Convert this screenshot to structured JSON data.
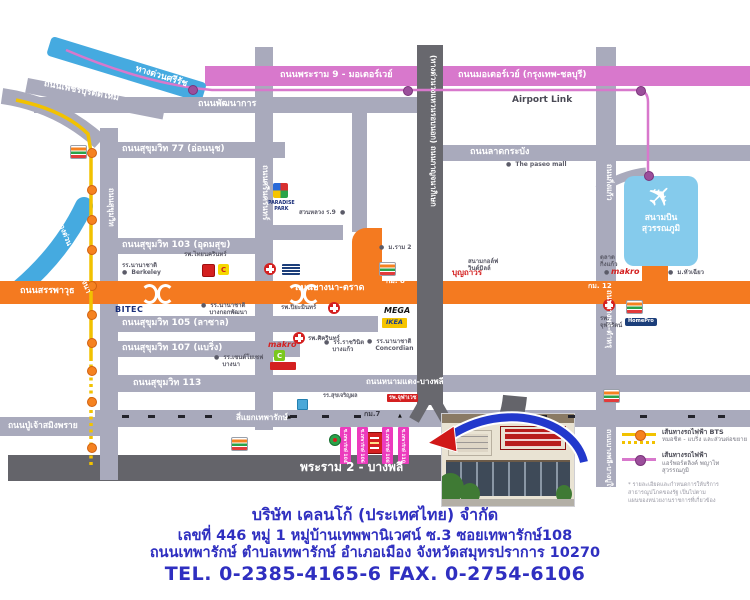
{
  "colors": {
    "white": "#ffffff",
    "road_gray": "#a9aabc",
    "road_dark": "#68686e",
    "road_dark2": "#64646a",
    "orange": "#f47a20",
    "pink_road": "#d878cc",
    "rail_dot_purple": "#9b4f9b",
    "expressway_blue": "#45aae0",
    "airport_blue": "#85cbec",
    "bts_yellow": "#f2c200",
    "bts_dot_orange": "#f58220",
    "soi_magenta": "#ec3bbd",
    "company_blue": "#2f2fc0",
    "accent_red": "#d42020",
    "label_gray": "#5b5b68"
  },
  "map": {
    "airport": {
      "plane_icon": "✈",
      "name": "สนามบิน\nสุวรรณภูมิ"
    },
    "labels": [
      {
        "n": "label-expressway-sirat",
        "t": "ทางด่วนศรีรัช",
        "x": 137,
        "y": 64,
        "c": "road",
        "r": 17
      },
      {
        "n": "label-rama9-motorway",
        "t": "ถนนพระราม 9 - มอเตอร์เวย์",
        "x": 280,
        "y": 70,
        "c": "road"
      },
      {
        "n": "label-motorway-bangkok-chonburi",
        "t": "ถนนมอเตอร์เวย์ (กรุงเทพ-ชลบุรี)",
        "x": 458,
        "y": 70,
        "c": "road"
      },
      {
        "n": "label-petchburi-tadmai",
        "t": "ถนนเพชรบุรีตัดใหม่",
        "x": 45,
        "y": 79,
        "c": "road",
        "r": 11
      },
      {
        "n": "label-pattanakarn",
        "t": "ถนนพัฒนาการ",
        "x": 198,
        "y": 99,
        "c": "road"
      },
      {
        "n": "label-airport-link",
        "t": "Airport Link",
        "x": 512,
        "y": 95,
        "c": "dark"
      },
      {
        "n": "label-ladkrabang",
        "t": "ถนนลาดกระบัง",
        "x": 470,
        "y": 147,
        "c": "road"
      },
      {
        "n": "label-sukhumvit-77",
        "t": "ถนนสุขุมวิท 77 (อ่อนนุช)",
        "x": 122,
        "y": 144,
        "c": "road"
      },
      {
        "n": "label-sukhumvit-103",
        "t": "ถนนสุขุมวิท 103 (อุดมสุข)",
        "x": 122,
        "y": 240,
        "c": "road"
      },
      {
        "n": "label-sanphawut",
        "t": "ถนนสรรพาวุธ",
        "x": 20,
        "y": 286,
        "c": "road"
      },
      {
        "n": "label-bangna-trad",
        "t": "ถนนบางนา-ตราด",
        "x": 295,
        "y": 283,
        "c": "road"
      },
      {
        "n": "label-km8",
        "t": "กม. 8",
        "x": 386,
        "y": 277,
        "c": "roadsm"
      },
      {
        "n": "label-km12",
        "t": "กม. 12",
        "x": 588,
        "y": 282,
        "c": "roadsm"
      },
      {
        "n": "label-sukhumvit-105",
        "t": "ถนนสุขุมวิท 105 (ลาซาล)",
        "x": 122,
        "y": 318,
        "c": "road"
      },
      {
        "n": "label-sukhumvit-107",
        "t": "ถนนสุขุมวิท 107 (แบริ่ง)",
        "x": 122,
        "y": 343,
        "c": "road"
      },
      {
        "n": "label-sukhumvit-113",
        "t": "ถนนสุขุมวิท 113",
        "x": 133,
        "y": 378,
        "c": "road"
      },
      {
        "n": "label-namdaeng-bangphli",
        "t": "ถนนหนามแดง-บางพลี",
        "x": 366,
        "y": 377,
        "c": "road",
        "s": 8
      },
      {
        "n": "label-yaek-theparak",
        "t": "สี่แยกเทพารักษ์",
        "x": 236,
        "y": 413,
        "c": "road",
        "s": 8
      },
      {
        "n": "label-poochao-samingprai",
        "t": "ถนนปู่เจ้าสมิงพราย",
        "x": 8,
        "y": 421,
        "c": "road",
        "s": 8.5
      },
      {
        "n": "label-rama2-bangphli",
        "t": "พระราม 2 - บางพลี",
        "x": 300,
        "y": 460,
        "c": "road",
        "s": 12
      },
      {
        "n": "label-km7",
        "t": "กม.7",
        "x": 364,
        "y": 410,
        "c": "km"
      },
      {
        "n": "label-srinakarin",
        "t": "ถนนศรีนครินทร์",
        "x": 270,
        "y": 165,
        "c": "road",
        "r": 90,
        "s": 8
      },
      {
        "n": "label-sukhumvit-old",
        "t": "ถนนสุขุมวิท",
        "x": 115,
        "y": 188,
        "c": "road",
        "r": 90,
        "s": 7.5
      },
      {
        "n": "label-kanchanaphisek",
        "t": "(ทางด่วนวงแหวนรอบนอก) ถนนกาญจนาภิเษก",
        "x": 437,
        "y": 55,
        "c": "road",
        "r": 90,
        "s": 7.5
      },
      {
        "n": "label-kingkaeo",
        "t": "ถนนกิ่งแก้ว",
        "x": 613,
        "y": 164,
        "c": "road",
        "r": 90,
        "s": 7.5
      },
      {
        "n": "label-bangphli-tamru",
        "t": "ถนนบางพลี-ตำหรุ",
        "x": 613,
        "y": 290,
        "c": "road",
        "r": 90,
        "s": 7.5
      },
      {
        "n": "label-bangphli-bangpoo",
        "t": "ถนนบางพลี-บางปูใหม่",
        "x": 613,
        "y": 429,
        "c": "road",
        "r": 90,
        "s": 7
      },
      {
        "n": "label-dindaeng-bangna",
        "t": "ทางด่วน ดินแดง-บางนา",
        "x": 63,
        "y": 219,
        "c": "road",
        "r": 68,
        "s": 7.5
      },
      {
        "n": "label-paradise-park",
        "t": "PARADISE\nPARK",
        "x": 268,
        "y": 201,
        "c": "paradise"
      },
      {
        "n": "label-suanluang-r9",
        "t": "สวนหลวง ร.9  ●",
        "x": 299,
        "y": 209,
        "c": "land"
      },
      {
        "n": "label-ram2-university",
        "t": "●  ม.ราม 2",
        "x": 379,
        "y": 244,
        "c": "land"
      },
      {
        "n": "label-boonthavorn",
        "t": "บุญถาวร",
        "x": 452,
        "y": 268,
        "c": "redtx"
      },
      {
        "n": "label-paseo-mall",
        "t": "●  The paseo mall",
        "x": 506,
        "y": 161,
        "c": "land"
      },
      {
        "n": "label-windmill",
        "t": "สนามกอล์ฟ\nวินด์มิลล์",
        "x": 468,
        "y": 258,
        "c": "land"
      },
      {
        "n": "label-talad-kingkaeo",
        "t": "ตลาด\nกิ่งแก้ว",
        "x": 600,
        "y": 254,
        "c": "land"
      },
      {
        "n": "label-makro-kingkaeo-bullet",
        "t": "●",
        "x": 604,
        "y": 269,
        "c": "land"
      },
      {
        "n": "label-makro-kingkaeo",
        "t": "makro",
        "x": 611,
        "y": 267,
        "c": "red"
      },
      {
        "n": "label-huachiew",
        "t": "●  ม.หัวเฉียว",
        "x": 668,
        "y": 269,
        "c": "land"
      },
      {
        "n": "label-thainakarin-hospital",
        "t": "รพ.ไทยนครินทร์",
        "x": 184,
        "y": 251,
        "c": "land"
      },
      {
        "n": "label-berkeley-school",
        "t": "รร.นานาชาติ\n●  Berkeley",
        "x": 122,
        "y": 262,
        "c": "land"
      },
      {
        "n": "label-bitec",
        "t": "BITEC",
        "x": 115,
        "y": 305,
        "c": "navy"
      },
      {
        "n": "label-bangkok-patana-school",
        "t": "●  รร.นานาชาติ\n    บางกอกพัฒนา",
        "x": 201,
        "y": 302,
        "c": "land"
      },
      {
        "n": "label-piyamin-hospital",
        "t": "รพ.ปิยะมินทร์",
        "x": 281,
        "y": 304,
        "c": "land"
      },
      {
        "n": "label-sikarin-hospital",
        "t": "รพ.ศิครินทร์",
        "x": 308,
        "y": 335,
        "c": "land"
      },
      {
        "n": "label-rajavinit-bangkaeo",
        "t": "●  รร.ราชวินิต\n    บางแก้ว",
        "x": 324,
        "y": 339,
        "c": "land"
      },
      {
        "n": "label-concordian-school",
        "t": "●  รร.นานาชาติ\n    Concordian",
        "x": 367,
        "y": 338,
        "c": "land"
      },
      {
        "n": "label-mega",
        "t": "MEGA",
        "x": 384,
        "y": 306,
        "c": "mega"
      },
      {
        "n": "label-ikea",
        "t": "IKEA",
        "x": 382,
        "y": 318,
        "c": "ikea"
      },
      {
        "n": "label-stjoseph-bangna",
        "t": "●  รร.เซนต์โยเซฟ\n    บางนา",
        "x": 214,
        "y": 354,
        "c": "land"
      },
      {
        "n": "label-makro-srinakarin",
        "t": "makro",
        "x": 268,
        "y": 340,
        "c": "red"
      },
      {
        "n": "label-central-c",
        "t": "C",
        "x": 221,
        "y": 266,
        "c": "cred"
      },
      {
        "n": "label-green-c",
        "t": "C",
        "x": 277,
        "y": 352,
        "c": "cwhite"
      },
      {
        "n": "label-sukjaroen-school",
        "t": "รร.สุขเจริญผล",
        "x": 323,
        "y": 393,
        "c": "land",
        "s": 5.5
      },
      {
        "n": "label-chulavej-hospital",
        "t": "รพ.จุฬาเวช",
        "x": 387,
        "y": 394,
        "c": "badge"
      },
      {
        "n": "label-chularat-hospital",
        "t": "รพ.\nจุฬารัตน์",
        "x": 600,
        "y": 315,
        "c": "land"
      },
      {
        "n": "label-homepro",
        "t": "HomePro",
        "x": 625,
        "y": 318,
        "c": "homepro"
      },
      {
        "n": "label-entrance-mark-1",
        "t": "▲",
        "x": 287,
        "y": 415,
        "c": "arrow"
      },
      {
        "n": "label-entrance-mark-2",
        "t": "▲",
        "x": 398,
        "y": 414,
        "c": "arrow"
      }
    ],
    "icons": [
      {
        "n": "seven-eleven-icon",
        "k": "seven",
        "x": 70,
        "y": 145
      },
      {
        "n": "seven-eleven-icon",
        "k": "seven",
        "x": 379,
        "y": 262
      },
      {
        "n": "seven-eleven-icon",
        "k": "seven",
        "x": 231,
        "y": 437
      },
      {
        "n": "seven-eleven-icon",
        "k": "seven",
        "x": 626,
        "y": 300
      },
      {
        "n": "seven-eleven-icon",
        "k": "seven",
        "x": 603,
        "y": 389
      },
      {
        "n": "hospital-cross-icon",
        "k": "cross",
        "x": 264,
        "y": 263
      },
      {
        "n": "hospital-cross-icon",
        "k": "cross",
        "x": 328,
        "y": 302
      },
      {
        "n": "hospital-cross-icon",
        "k": "cross",
        "x": 293,
        "y": 332
      },
      {
        "n": "hospital-cross-icon",
        "k": "cross",
        "x": 603,
        "y": 299
      },
      {
        "n": "store-logo-red-icon",
        "k": "redsq",
        "x": 202,
        "y": 264
      },
      {
        "n": "central-logo-icon",
        "k": "cbox",
        "x": 218,
        "y": 264
      },
      {
        "n": "central-city-logo-icon",
        "k": "navy",
        "x": 282,
        "y": 264
      },
      {
        "n": "store-logo-green-icon",
        "k": "gbox",
        "x": 274,
        "y": 350
      },
      {
        "n": "store-logo-redwide-icon",
        "k": "redwide",
        "x": 270,
        "y": 362
      },
      {
        "n": "bank-logo-blue-icon",
        "k": "bluecube",
        "x": 297,
        "y": 399
      },
      {
        "n": "logo-green-circle-icon",
        "k": "gcircle",
        "x": 329,
        "y": 434
      },
      {
        "n": "paradise-park-logo-icon",
        "k": "paradise",
        "x": 273,
        "y": 183
      },
      {
        "n": "company-location-marker",
        "k": "marker",
        "x": 366,
        "y": 432
      },
      {
        "n": "poi-dot-icon",
        "k": "dotg",
        "x": 339,
        "y": 402
      },
      {
        "n": "interchange-arc-icon",
        "k": "arcl",
        "x": 141,
        "y": 284
      },
      {
        "n": "interchange-arc-icon",
        "k": "arcr",
        "x": 157,
        "y": 284
      },
      {
        "n": "interchange-arc-icon",
        "k": "arcl",
        "x": 287,
        "y": 284
      },
      {
        "n": "interchange-arc-icon",
        "k": "arcr",
        "x": 303,
        "y": 284
      }
    ],
    "bts_dots": [
      [
        87,
        148
      ],
      [
        87,
        185
      ],
      [
        87,
        215
      ],
      [
        87,
        245
      ],
      [
        87,
        281
      ],
      [
        87,
        310
      ],
      [
        87,
        338
      ],
      [
        87,
        366
      ],
      [
        87,
        397
      ],
      [
        87,
        443
      ]
    ],
    "arl_dots": [
      [
        188,
        85
      ],
      [
        403,
        86
      ],
      [
        636,
        86
      ],
      [
        644,
        171
      ]
    ],
    "bus_dashes": [
      122,
      148,
      178,
      205,
      290,
      322,
      354,
      512,
      540,
      568,
      640,
      688,
      718
    ],
    "sois": [
      {
        "t": "ซ.เทพารักษ์ 104",
        "x": 340
      },
      {
        "t": "ซ.เทพารักษ์ 106",
        "x": 357
      },
      {
        "t": "ซ.เทพารักษ์ 108",
        "x": 382
      },
      {
        "t": "ซ.เทพารักษ์ 110",
        "x": 398
      }
    ],
    "legend": {
      "bts": {
        "line1": "เส้นทางรถไฟฟ้า BTS",
        "line2": "หมอชิต - แบริ่ง และส่วนต่อขยาย"
      },
      "arl": {
        "line1": "เส้นทางรถไฟฟ้า",
        "line2": "แอร์พอร์ตลิงค์ พญาไท สุวรรณภูมิ"
      },
      "note": "* รายละเอียดและกำหนดการให้บริการ\nสาธารณูปโภคของรัฐ เป็นไปตาม\nแผนของหน่วยงานราชการที่เกี่ยวข้อง"
    }
  },
  "company": {
    "name": "บริษัท เคลนโก้ (ประเทศไทย) จำกัด",
    "address1": "เลขที่  446  หมู่ 1 หมู่บ้านเทพพานิเวศน์ ซ.3   ซอยเทพารักษ์108",
    "address2": "ถนนเทพารักษ์  ตำบลเทพารักษ์  อำเภอเมือง  จังหวัดสมุทรปราการ  10270",
    "phone": "TEL. 0-2385-4165-6   FAX. 0-2754-6106"
  }
}
